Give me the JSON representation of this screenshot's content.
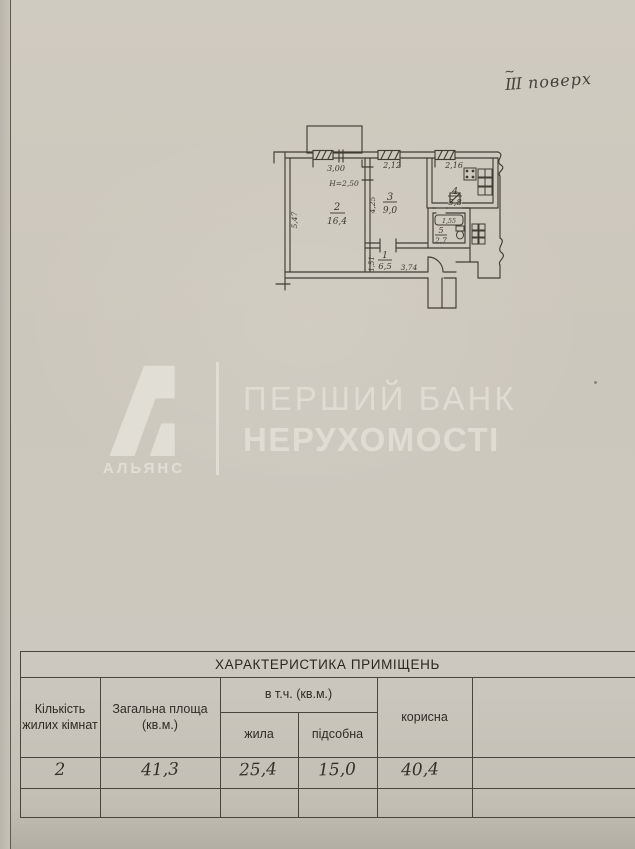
{
  "note": {
    "roman": "ІІІ",
    "tilde": "~",
    "word": "поверх"
  },
  "watermark": {
    "brand": "АЛЬЯНС",
    "line1": "ПЕРШИЙ БАНК",
    "line2": "НЕРУХОМОСТІ",
    "color": "#e0ddd5"
  },
  "plan": {
    "rooms": [
      {
        "num": "1",
        "area": "6,5"
      },
      {
        "num": "2",
        "area": "16,4"
      },
      {
        "num": "3",
        "area": "9,0"
      },
      {
        "num": "4",
        "area": "5,8"
      },
      {
        "num": "5",
        "area": "2,7"
      }
    ],
    "dims": {
      "room2_width": "3,00",
      "room2_height": "5,47",
      "ceiling_height": "Н=2,50",
      "room3_width": "2,12",
      "room3_height": "4,25",
      "room4_width": "2,16",
      "tub": "1,55",
      "hall_width": "3,74",
      "hall_height": "1,51"
    }
  },
  "table": {
    "title": "ХАРАКТЕРИСТИКА ПРИМІЩЕНЬ",
    "col_rooms": "Кількість жилих кімнат",
    "col_total": "Загальна площа (кв.м.)",
    "col_incl": "в т.ч. (кв.м.)",
    "col_living": "жила",
    "col_aux": "підсобна",
    "col_useful": "корисна",
    "row": {
      "rooms": "2",
      "total": "41,3",
      "living": "25,4",
      "aux": "15,0",
      "useful": "40,4"
    }
  }
}
